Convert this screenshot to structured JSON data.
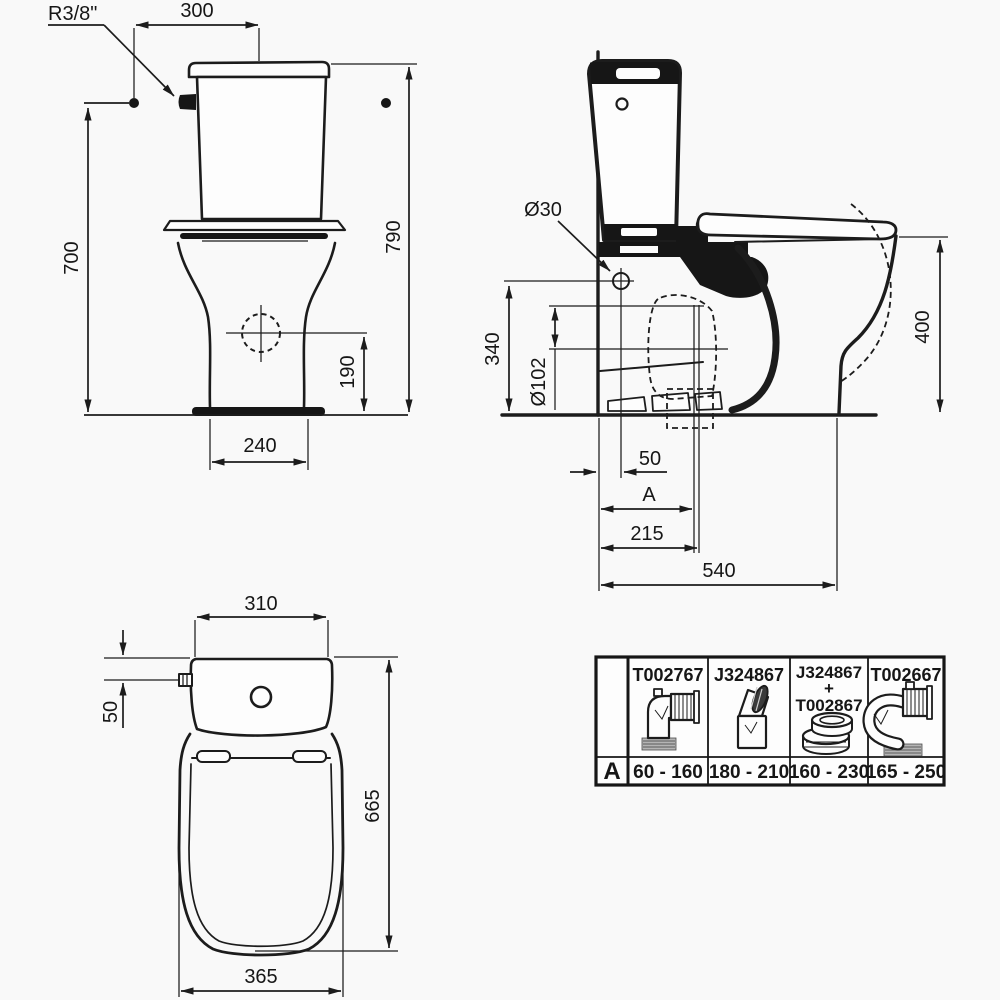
{
  "front_view": {
    "inlet_thread_label": "R3/8\"",
    "inlet_to_center_width": "300",
    "inlet_height": "700",
    "total_height": "790",
    "side_hole_height": "190",
    "base_width": "240"
  },
  "side_view": {
    "fixing_hole_dia": "Ø30",
    "fixing_hole_height": "340",
    "outlet_dia": "Ø102",
    "rim_height": "400",
    "wall_to_fixing_hole": "50",
    "outlet_distance_label": "A",
    "wall_to_vertical_outlet": "215",
    "total_depth": "540"
  },
  "top_view": {
    "cistern_width": "310",
    "inlet_offset": "50",
    "total_depth": "665",
    "bowl_width": "365"
  },
  "connector_table": {
    "row_label": "A",
    "columns": [
      {
        "part_lines": [
          "T002767"
        ],
        "a_range": "60 - 160",
        "icon": "elbow-pan-connector"
      },
      {
        "part_lines": [
          "J324867"
        ],
        "a_range": "180 - 210",
        "icon": "angled-pan-connector"
      },
      {
        "part_lines": [
          "J324867",
          "+",
          "T002867"
        ],
        "a_range": "160 - 230",
        "icon": "offset-ring-connector"
      },
      {
        "part_lines": [
          "T002667"
        ],
        "a_range": "165 - 250",
        "icon": "s-bend-pan-connector"
      }
    ]
  },
  "colors": {
    "line": "#1c1c1c",
    "background": "#f9f9f9",
    "dark_fill": "#161616"
  }
}
